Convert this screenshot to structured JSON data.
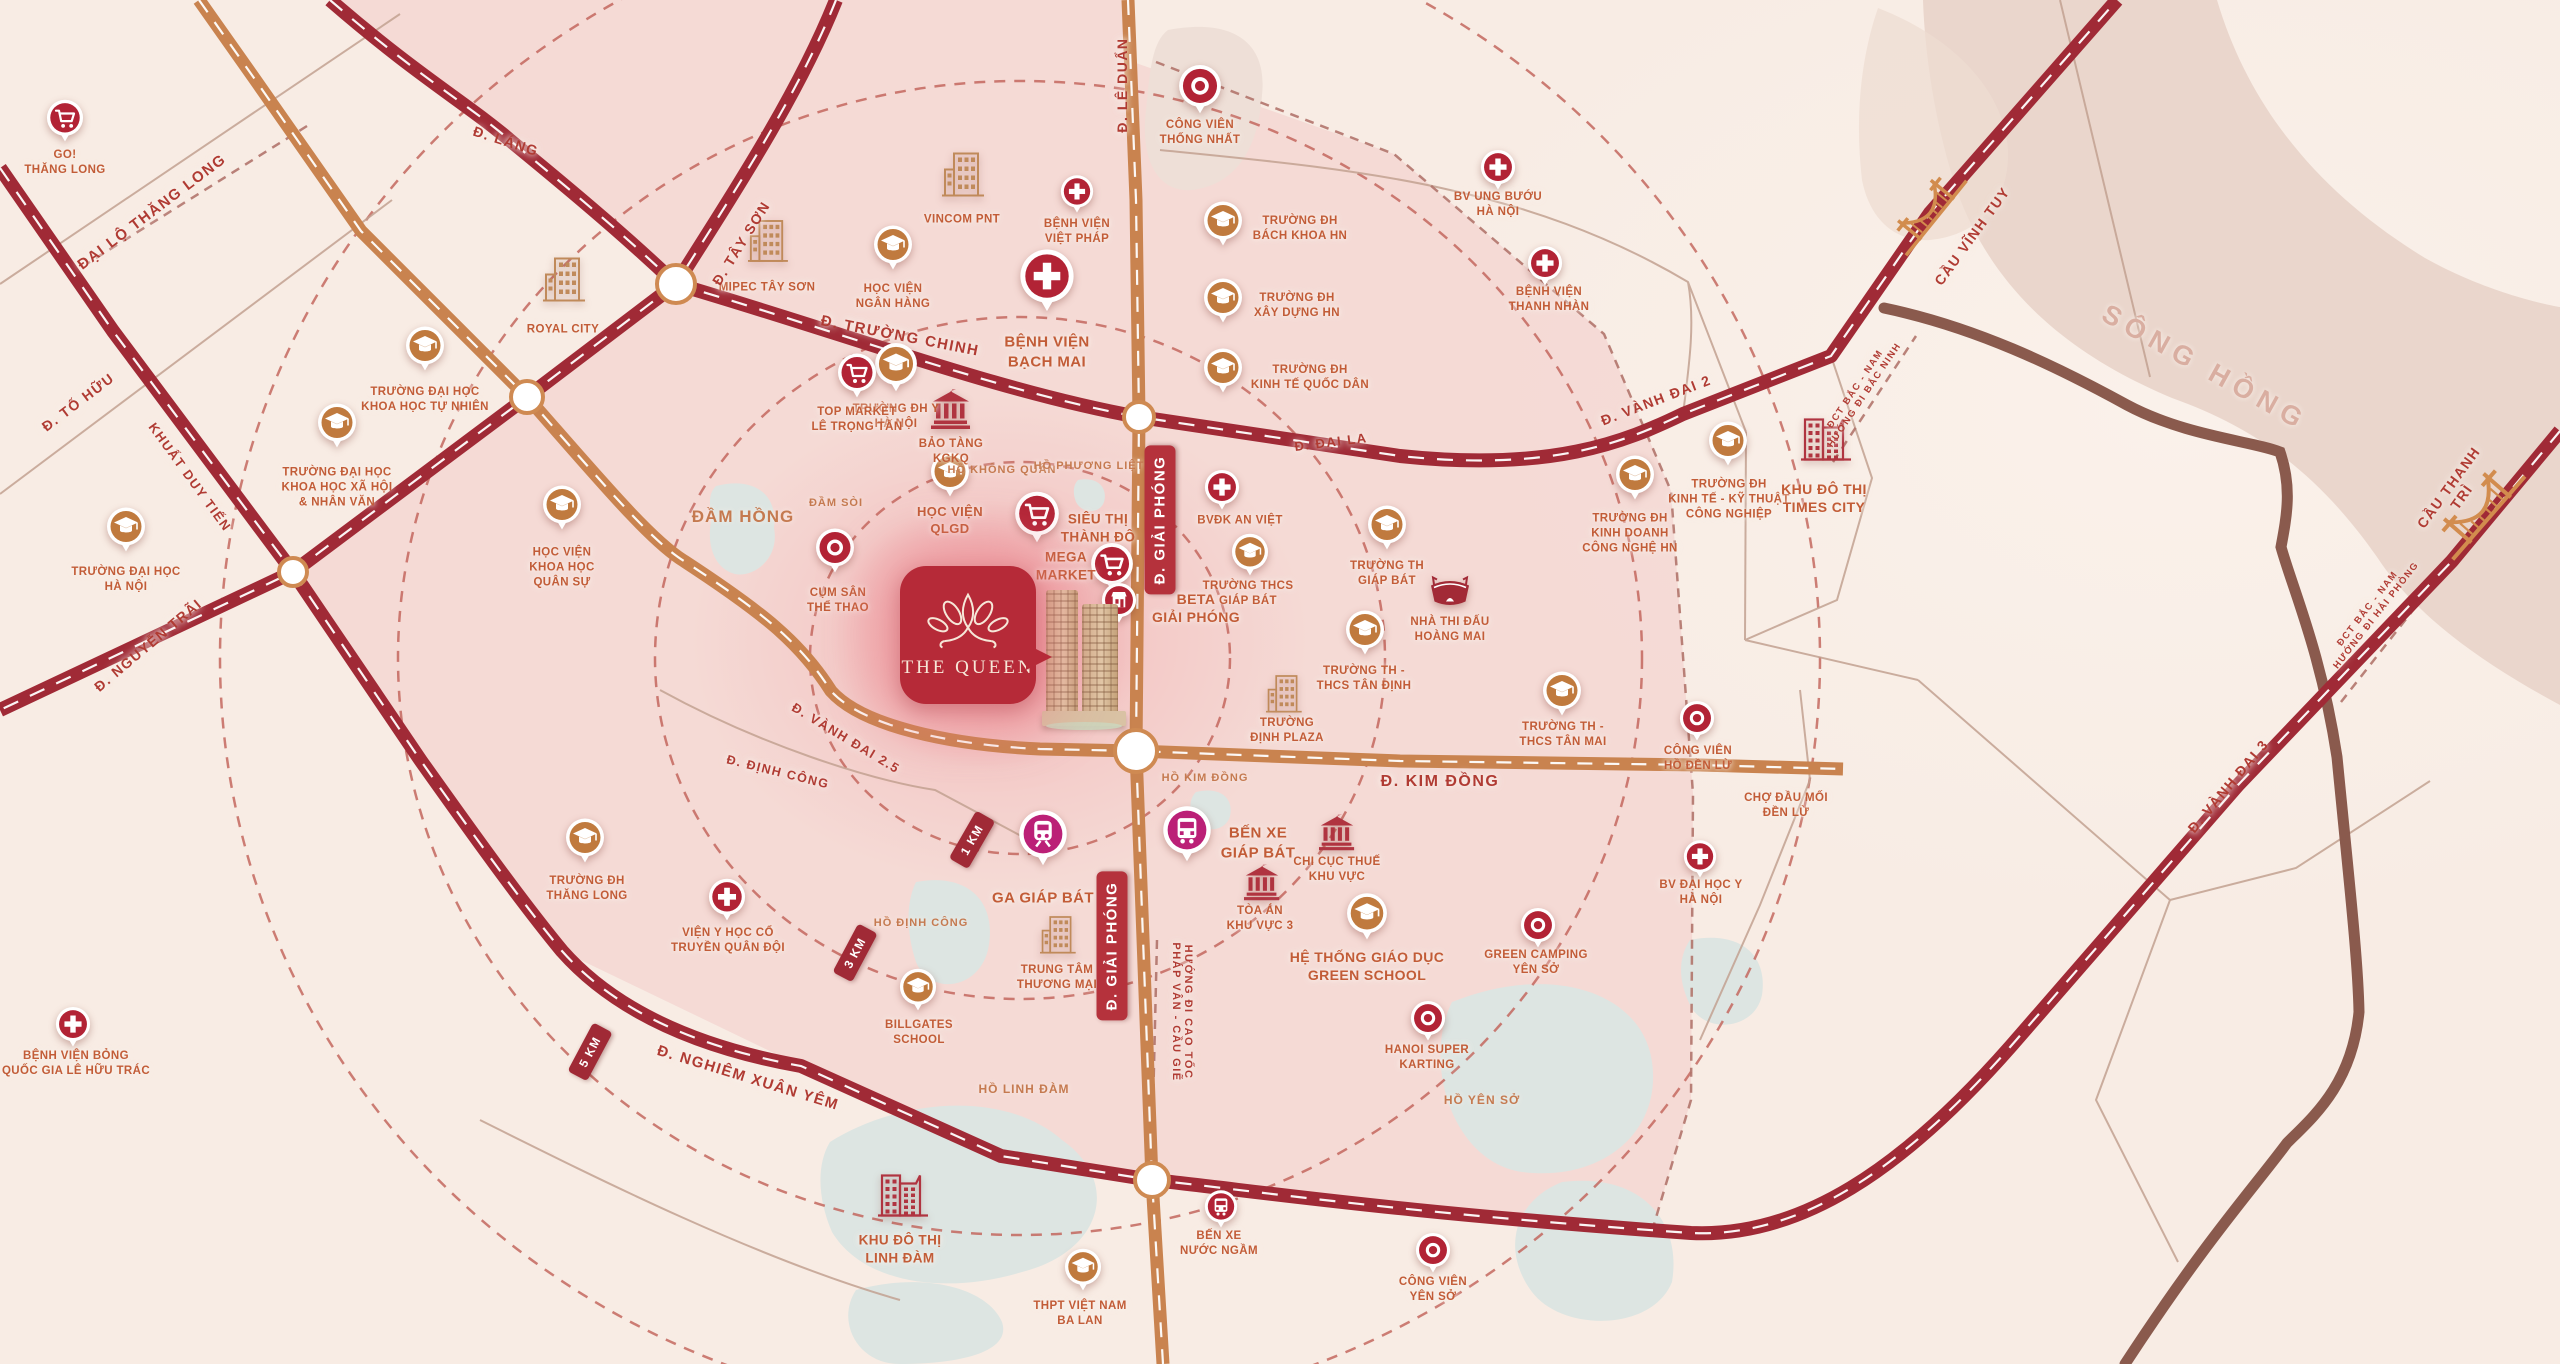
{
  "project": {
    "name": "THE QUEEN",
    "logo": "lotus-crown-icon",
    "callout_color": "#b62a38"
  },
  "colors": {
    "bg": "#f8ece4",
    "pink_zone": "#f2c7c5",
    "road_dark_red": "#a02a36",
    "road_orange": "#c9834f",
    "road_brown": "#8a5a4d",
    "river": "#ead6cc",
    "lake": "#dde5e2",
    "ring_dash": "#c4685f",
    "poi_label": "#c25c37",
    "road_label": "#b03b33",
    "school_pin": "#c07a3e",
    "hospital_pin": "#b22335",
    "transit_pin": "#bb2077"
  },
  "river": {
    "name": "SÔNG HỒNG",
    "x": 2205,
    "y": 368,
    "rot": 29
  },
  "road_labels": [
    {
      "t": "ĐẠI LỘ THĂNG LONG",
      "x": 152,
      "y": 212,
      "r": -37,
      "s": 15
    },
    {
      "t": "Đ. TỐ HỮU",
      "x": 78,
      "y": 402,
      "r": -37,
      "s": 14
    },
    {
      "t": "Đ. LÁNG",
      "x": 506,
      "y": 141,
      "r": 18,
      "s": 14
    },
    {
      "t": "Đ. TÂY SƠN",
      "x": 741,
      "y": 243,
      "r": -58,
      "s": 14
    },
    {
      "t": "Đ. TRƯỜNG CHINH",
      "x": 900,
      "y": 336,
      "r": 11,
      "s": 15
    },
    {
      "t": "Đ. LÊ DUẨN",
      "x": 1122,
      "y": 85,
      "r": -90,
      "s": 14
    },
    {
      "t": "Đ. ĐẠI LA",
      "x": 1331,
      "y": 442,
      "r": -7,
      "s": 13
    },
    {
      "t": "Đ. VÀNH ĐAI 2",
      "x": 1656,
      "y": 400,
      "r": -21,
      "s": 14
    },
    {
      "t": "Đ. VÀNH ĐAI 2.5",
      "x": 846,
      "y": 738,
      "r": 31,
      "s": 13
    },
    {
      "t": "Đ. ĐỊNH CÔNG",
      "x": 778,
      "y": 772,
      "r": 14,
      "s": 12.5
    },
    {
      "t": "Đ. KIM ĐỒNG",
      "x": 1440,
      "y": 782,
      "r": 0,
      "s": 16
    },
    {
      "t": "Đ. NGUYỄN TRÃI",
      "x": 148,
      "y": 645,
      "r": -40,
      "s": 14
    },
    {
      "t": "KHUẤT DUY TIẾN",
      "x": 190,
      "y": 477,
      "r": 54,
      "s": 13
    },
    {
      "t": "Đ. NGHIÊM XUÂN YÊM",
      "x": 748,
      "y": 1078,
      "r": 17,
      "s": 15
    },
    {
      "t": "Đ. VÀNH ĐAI 3",
      "x": 2228,
      "y": 786,
      "r": -50,
      "s": 14
    },
    {
      "t": "CẦU VĨNH TUY",
      "x": 1972,
      "y": 236,
      "r": -54,
      "s": 14
    },
    {
      "t": "CẦU THANH TRÌ",
      "x": 2455,
      "y": 492,
      "r": -54,
      "s": 14
    },
    {
      "t": "ĐCT BẮC - NAM\nHƯỚNG ĐI BẮC NINH",
      "x": 1860,
      "y": 392,
      "r": -56,
      "s": 9.5
    },
    {
      "t": "ĐCT BẮC - NAM\nHƯỚNG ĐI HẢI PHÒNG",
      "x": 2372,
      "y": 612,
      "r": -52,
      "s": 9.5
    },
    {
      "t": "HƯỚNG ĐI CAO TỐC\nPHÁP VÂN - CẦU GIẼ",
      "x": 1182,
      "y": 1012,
      "r": 90,
      "s": 11
    }
  ],
  "water_labels": [
    {
      "t": "ĐẦM HỒNG",
      "x": 743,
      "y": 517,
      "s": 17
    },
    {
      "t": "ĐẦM SÒI",
      "x": 836,
      "y": 503,
      "s": 11
    },
    {
      "t": "HỒ KHÔNG QUÂN",
      "x": 1002,
      "y": 470,
      "s": 11
    },
    {
      "t": "HỒ PHƯƠNG LIỆT",
      "x": 1089,
      "y": 466,
      "s": 11
    },
    {
      "t": "HỒ KIM ĐỒNG",
      "x": 1205,
      "y": 778,
      "s": 11
    },
    {
      "t": "HỒ ĐỊNH CÔNG",
      "x": 921,
      "y": 923,
      "s": 11
    },
    {
      "t": "HỒ LINH ĐÀM",
      "x": 1024,
      "y": 1089,
      "s": 12
    },
    {
      "t": "HỒ YÊN SỞ",
      "x": 1482,
      "y": 1100,
      "s": 12
    }
  ],
  "badges": [
    {
      "t": "Đ. GIẢI PHÓNG",
      "x": 1160,
      "y": 520,
      "r": -90,
      "kind": "road"
    },
    {
      "t": "Đ. GIẢI PHÓNG",
      "x": 1112,
      "y": 946,
      "r": -90,
      "kind": "road"
    },
    {
      "t": "1 KM",
      "x": 972,
      "y": 840,
      "r": -60,
      "kind": "km"
    },
    {
      "t": "3 KM",
      "x": 855,
      "y": 953,
      "r": -62,
      "kind": "km"
    },
    {
      "t": "5 KM",
      "x": 590,
      "y": 1052,
      "r": -62,
      "kind": "km"
    }
  ],
  "pois": [
    {
      "t": "GO!\nTHĂNG LONG",
      "type": "cart",
      "x": 65,
      "y": 122,
      "lx": 65,
      "ly": 163,
      "sz": 0.95
    },
    {
      "t": "TRƯỜNG ĐẠI HỌC\nKHOA HỌC TỰ NHIÊN",
      "type": "school",
      "x": 425,
      "y": 351,
      "lx": 425,
      "ly": 400
    },
    {
      "t": "TRƯỜNG ĐẠI HỌC\nKHOA HỌC XÃ HỘI\n& NHÂN VĂN",
      "type": "school",
      "x": 337,
      "y": 428,
      "lx": 337,
      "ly": 488
    },
    {
      "t": "TRƯỜNG ĐẠI HỌC\nHÀ NỘI",
      "type": "school",
      "x": 126,
      "y": 532,
      "lx": 126,
      "ly": 580
    },
    {
      "t": "HỌC VIỆN\nKHOA HỌC\nQUÂN SỰ",
      "type": "school",
      "x": 562,
      "y": 510,
      "lx": 562,
      "ly": 568
    },
    {
      "t": "ROYAL CITY",
      "type": "building",
      "x": 563,
      "y": 283,
      "lx": 563,
      "ly": 330,
      "sz": 1.0
    },
    {
      "t": "MIPEC TÂY SƠN",
      "type": "building",
      "x": 767,
      "y": 243,
      "lx": 767,
      "ly": 288,
      "sz": 0.95
    },
    {
      "t": "HỌC VIỆN\nNGÂN HÀNG",
      "type": "school",
      "x": 893,
      "y": 250,
      "lx": 893,
      "ly": 297
    },
    {
      "t": "VINCOM PNT",
      "type": "building",
      "x": 962,
      "y": 178,
      "lx": 962,
      "ly": 220,
      "sz": 1.0
    },
    {
      "t": "BỆNH VIỆN\nVIỆT PHÁP",
      "type": "hospital",
      "x": 1077,
      "y": 193,
      "lx": 1077,
      "ly": 232,
      "sz": 0.85
    },
    {
      "t": "TRƯỜNG ĐH Y\nHÀ NỘI",
      "type": "school",
      "x": 896,
      "y": 372,
      "lx": 896,
      "ly": 417,
      "sz": 1.1
    },
    {
      "t": "BỆNH VIỆN\nBẠCH MAI",
      "type": "hospital",
      "x": 1047,
      "y": 292,
      "lx": 1047,
      "ly": 352,
      "sz": 1.4,
      "ls": 15
    },
    {
      "t": "TOP MARKET\nLÊ TRỌNG TẤN",
      "type": "cart",
      "x": 857,
      "y": 378,
      "lx": 857,
      "ly": 420
    },
    {
      "t": "BẢO TÀNG\nKGKQ",
      "type": "bank",
      "x": 951,
      "y": 413,
      "lx": 951,
      "ly": 452
    },
    {
      "t": "HỌC VIỆN\nQLGD",
      "type": "school",
      "x": 950,
      "y": 477,
      "lx": 950,
      "ly": 521,
      "ls": 13
    },
    {
      "t": "SIÊU THỊ\nTHÀNH ĐÔ",
      "type": "cart",
      "x": 1037,
      "y": 523,
      "lx": 1098,
      "ly": 528,
      "sz": 1.15,
      "ls": 13.5
    },
    {
      "t": "MEGA\nMARKET",
      "type": "cart",
      "x": 1112,
      "y": 572,
      "lx": 1066,
      "ly": 566,
      "sz": 1.1,
      "ls": 13.5
    },
    {
      "t": "BETA\nGIẢI PHÓNG",
      "type": "store",
      "x": 1119,
      "y": 603,
      "lx": 1196,
      "ly": 608,
      "sz": 0.9,
      "ls": 14
    },
    {
      "t": "CÔNG VIÊN\nTHỐNG NHẤT",
      "type": "park",
      "x": 1200,
      "y": 94,
      "lx": 1200,
      "ly": 133,
      "sz": 1.1
    },
    {
      "t": "BV UNG BƯỚU\nHÀ NỘI",
      "type": "hospital",
      "x": 1498,
      "y": 170,
      "lx": 1498,
      "ly": 205,
      "sz": 0.9
    },
    {
      "t": "TRƯỜNG ĐH\nBÁCH KHOA HN",
      "type": "school",
      "x": 1223,
      "y": 226,
      "lx": 1300,
      "ly": 229
    },
    {
      "t": "TRƯỜNG ĐH\nXÂY DỰNG HN",
      "type": "school",
      "x": 1223,
      "y": 303,
      "lx": 1297,
      "ly": 306
    },
    {
      "t": "TRƯỜNG ĐH\nKINH TẾ QUỐC DÂN",
      "type": "school",
      "x": 1223,
      "y": 373,
      "lx": 1310,
      "ly": 378
    },
    {
      "t": "BỆNH VIỆN\nTHANH NHÀN",
      "type": "hospital",
      "x": 1545,
      "y": 266,
      "lx": 1549,
      "ly": 300,
      "sz": 0.9
    },
    {
      "t": "BVĐK AN VIỆT",
      "type": "hospital",
      "x": 1222,
      "y": 490,
      "lx": 1240,
      "ly": 521,
      "sz": 0.9
    },
    {
      "t": "TRƯỜNG THCS\nGIÁP BÁT",
      "type": "school",
      "x": 1250,
      "y": 556,
      "lx": 1248,
      "ly": 594,
      "sz": 0.95
    },
    {
      "t": "CỤM SÂN\nTHỂ THAO",
      "type": "park",
      "x": 835,
      "y": 553,
      "lx": 838,
      "ly": 601
    },
    {
      "t": "TRƯỜNG TH\nGIÁP BÁT",
      "type": "school",
      "x": 1387,
      "y": 530,
      "lx": 1387,
      "ly": 574
    },
    {
      "t": "NHÀ THI ĐẤU\nHOÀNG MAI",
      "type": "stadium",
      "x": 1450,
      "y": 594,
      "lx": 1450,
      "ly": 630
    },
    {
      "t": "TRƯỜNG TH -\nTHCS TÂN ĐỊNH",
      "type": "school",
      "x": 1365,
      "y": 635,
      "lx": 1364,
      "ly": 679
    },
    {
      "t": "TRƯỜNG TH -\nTHCS TÂN MAI",
      "type": "school",
      "x": 1562,
      "y": 696,
      "lx": 1563,
      "ly": 735
    },
    {
      "t": "TRƯỜNG\nĐỊNH PLAZA",
      "type": "building",
      "x": 1283,
      "y": 693,
      "lx": 1287,
      "ly": 731,
      "sz": 0.85
    },
    {
      "t": "TRƯỜNG ĐH\nKINH DOANH\nCÔNG NGHỆ HN",
      "type": "school",
      "x": 1635,
      "y": 480,
      "lx": 1630,
      "ly": 534
    },
    {
      "t": "TRƯỜNG ĐH\nKINH TẾ - KỸ THUẬT\nCÔNG NGHIỆP",
      "type": "school",
      "x": 1728,
      "y": 446,
      "lx": 1729,
      "ly": 500
    },
    {
      "t": "KHU ĐÔ THỊ\nTIMES CITY",
      "type": "citybuilding",
      "x": 1825,
      "y": 442,
      "lx": 1824,
      "ly": 498,
      "ls": 14
    },
    {
      "t": "CÔNG VIÊN\nHỒ ĐỀN LỪ",
      "type": "park",
      "x": 1697,
      "y": 721,
      "lx": 1698,
      "ly": 759,
      "sz": 0.9
    },
    {
      "t": "CHỢ ĐẦU MỐI\nĐỀN LỪ",
      "type": "none",
      "x": 1786,
      "y": 806,
      "lx": 1786,
      "ly": 806
    },
    {
      "t": "BV ĐẠI HỌC Y\nHÀ NỘI",
      "type": "hospital",
      "x": 1700,
      "y": 858,
      "lx": 1701,
      "ly": 893,
      "sz": 0.85
    },
    {
      "t": "GA GIÁP BÁT",
      "type": "train",
      "x": 1043,
      "y": 846,
      "lx": 1043,
      "ly": 898,
      "sz": 1.25,
      "ls": 15
    },
    {
      "t": "TRUNG TÂM\nTHƯƠNG MẠI",
      "type": "building",
      "x": 1057,
      "y": 934,
      "lx": 1057,
      "ly": 978,
      "sz": 0.85
    },
    {
      "t": "BẾN XE\nGIÁP BÁT",
      "type": "bus",
      "x": 1187,
      "y": 842,
      "lx": 1258,
      "ly": 843,
      "sz": 1.25,
      "ls": 15
    },
    {
      "t": "CHI CỤC THUẾ\nKHU VỰC",
      "type": "bank",
      "x": 1337,
      "y": 834,
      "lx": 1337,
      "ly": 870,
      "sz": 0.9
    },
    {
      "t": "TÒA ÁN\nKHU VỰC 3",
      "type": "bank",
      "x": 1262,
      "y": 884,
      "lx": 1260,
      "ly": 919,
      "sz": 0.9
    },
    {
      "t": "HỆ THỐNG GIÁO DỤC\nGREEN SCHOOL",
      "type": "school",
      "x": 1367,
      "y": 920,
      "lx": 1367,
      "ly": 966,
      "sz": 1.05,
      "ls": 14
    },
    {
      "t": "GREEN CAMPING\nYÊN SỞ",
      "type": "park",
      "x": 1538,
      "y": 928,
      "lx": 1536,
      "ly": 963,
      "sz": 0.9
    },
    {
      "t": "HANOI SUPER\nKARTING",
      "type": "park",
      "x": 1428,
      "y": 1021,
      "lx": 1427,
      "ly": 1058,
      "sz": 0.9
    },
    {
      "t": "TRƯỜNG ĐH\nTHĂNG LONG",
      "type": "school",
      "x": 585,
      "y": 843,
      "lx": 587,
      "ly": 889
    },
    {
      "t": "VIỆN Y HỌC CỔ\nTRUYỀN QUÂN ĐỘI",
      "type": "hospital",
      "x": 727,
      "y": 901,
      "lx": 728,
      "ly": 941,
      "sz": 0.95
    },
    {
      "t": "BILLGATES\nSCHOOL",
      "type": "school",
      "x": 918,
      "y": 991,
      "lx": 919,
      "ly": 1033,
      "sz": 0.95
    },
    {
      "t": "BỆNH VIỆN BỎNG\nQUỐC GIA LÊ HỮU TRÁC",
      "type": "hospital",
      "x": 73,
      "y": 1027,
      "lx": 76,
      "ly": 1064,
      "sz": 0.9
    },
    {
      "t": "KHU ĐÔ THỊ\nLINH ĐÀM",
      "type": "citybuilding",
      "x": 902,
      "y": 1198,
      "lx": 900,
      "ly": 1249,
      "ls": 13.5
    },
    {
      "t": "THPT VIỆT NAM\nBA LAN",
      "type": "school",
      "x": 1083,
      "y": 1271,
      "lx": 1080,
      "ly": 1314,
      "sz": 0.95
    },
    {
      "t": "BẾN XE\nNƯỚC NGẦM",
      "type": "busred",
      "x": 1221,
      "y": 1208,
      "lx": 1219,
      "ly": 1244,
      "sz": 0.85
    },
    {
      "t": "CÔNG VIÊN\nYÊN SỞ",
      "type": "park",
      "x": 1433,
      "y": 1253,
      "lx": 1433,
      "ly": 1290,
      "sz": 0.9
    }
  ]
}
